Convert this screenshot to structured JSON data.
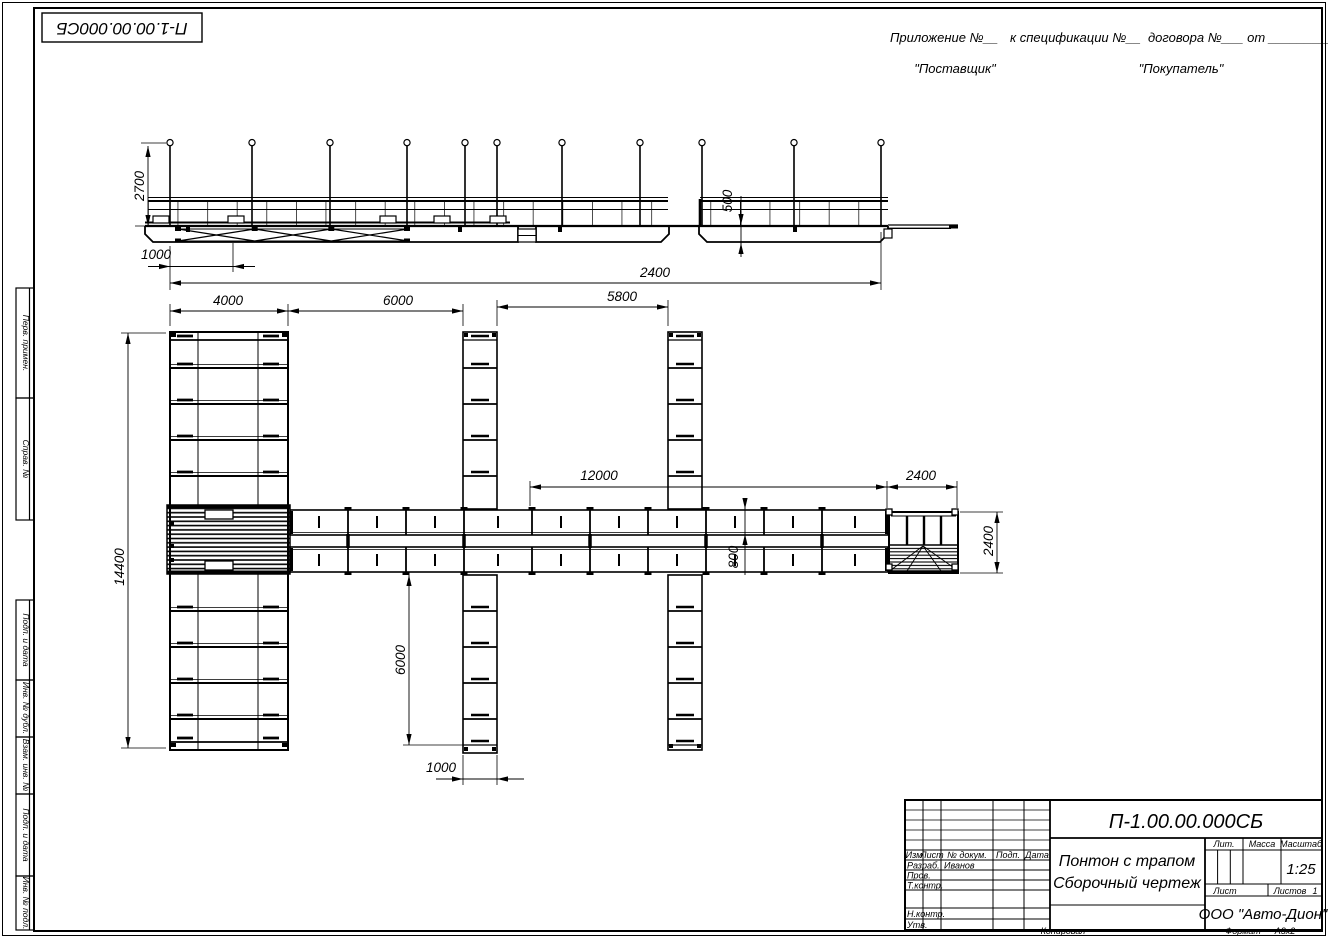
{
  "sheet": {
    "doc_number_top": "П-1.00.00.000СБ",
    "appendix_part1": "Приложение №__",
    "appendix_part2": "к спецификации №__",
    "appendix_part3": "договора №___  от _________",
    "supplier": "\"Поставщик\"",
    "buyer": "\"Покупатель\"",
    "copied": "Копировал",
    "format_label": "Формат",
    "format_value": "А3х2"
  },
  "margin": {
    "first_use": "Перв. примен.",
    "ref_no": "Справ. №",
    "sign_date1": "Подп. и дата",
    "inv_dupl": "Инв. № дубл.",
    "repl_inv": "Взам. инв. №",
    "sign_date2": "Подп. и дата",
    "inv_orig": "Инв. № подл."
  },
  "title_block": {
    "doc_number": "П-1.00.00.000СБ",
    "product_title": "Понтон с трапом",
    "doc_type": "Сборочный чертеж",
    "col_izm": "Изм",
    "col_list": "Лист",
    "col_doc": "№ докум.",
    "col_sign": "Подп.",
    "col_date": "Дата",
    "row_dev": "Разраб.",
    "row_check": "Пров.",
    "row_tcontrol": "Т.контр.",
    "row_ncontrol": "Н.контр.",
    "row_approve": "Утв.",
    "developer_name": "Иванов",
    "lit": "Лит.",
    "mass": "Масса",
    "scale_label": "Масштаб",
    "scale_value": "1:25",
    "sheet_label": "Лист",
    "sheets_label": "Листов",
    "sheets_count": "1",
    "company": "ООО \"Авто-Дион\""
  },
  "dims": {
    "height2700": "2700",
    "offset1000": "1000",
    "span2400": "2400",
    "freeboard500": "500",
    "pier4000": "4000",
    "gap6000": "6000",
    "gap5800": "5800",
    "walk12000": "12000",
    "trap2400": "2400",
    "trapw2400": "2400",
    "pier14400": "14400",
    "finger6000": "6000",
    "finger1000": "1000",
    "walk800": "800"
  }
}
